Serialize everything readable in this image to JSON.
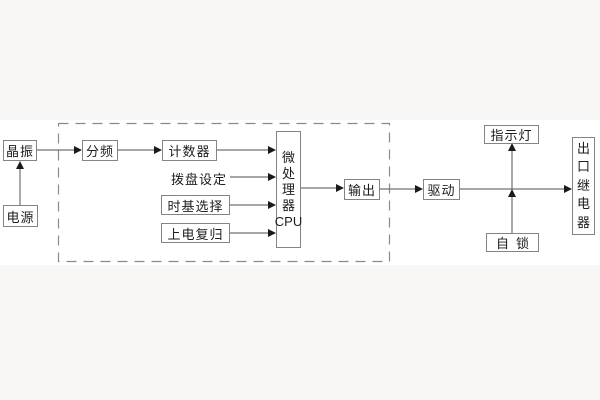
{
  "diagram": {
    "title_none": "",
    "nodes": {
      "crystal": {
        "label": "晶振"
      },
      "power": {
        "label": "电源"
      },
      "divider": {
        "label": "分频"
      },
      "counter": {
        "label": "计数器"
      },
      "dial": {
        "label": "拨盘设定"
      },
      "timebase": {
        "label": "时基选择"
      },
      "reset": {
        "label": "上电复归"
      },
      "cpu": {
        "chars": [
          "微",
          "处",
          "理",
          "器"
        ],
        "caption": "CPU"
      },
      "output": {
        "label": "输出"
      },
      "drive": {
        "label": "驱动"
      },
      "indicator": {
        "label": "指示灯"
      },
      "selflock": {
        "label": "自锁"
      },
      "relay": {
        "chars": [
          "出",
          "口",
          "继",
          "电",
          "器"
        ]
      }
    },
    "colors": {
      "background": "#f8f7f5",
      "band": "#ffffff",
      "box_border": "#848484",
      "line": "#707070",
      "arrowhead": "#1a1a1a",
      "dashed_boundary": "#8a8a8a",
      "text": "#1c1c1c"
    }
  }
}
